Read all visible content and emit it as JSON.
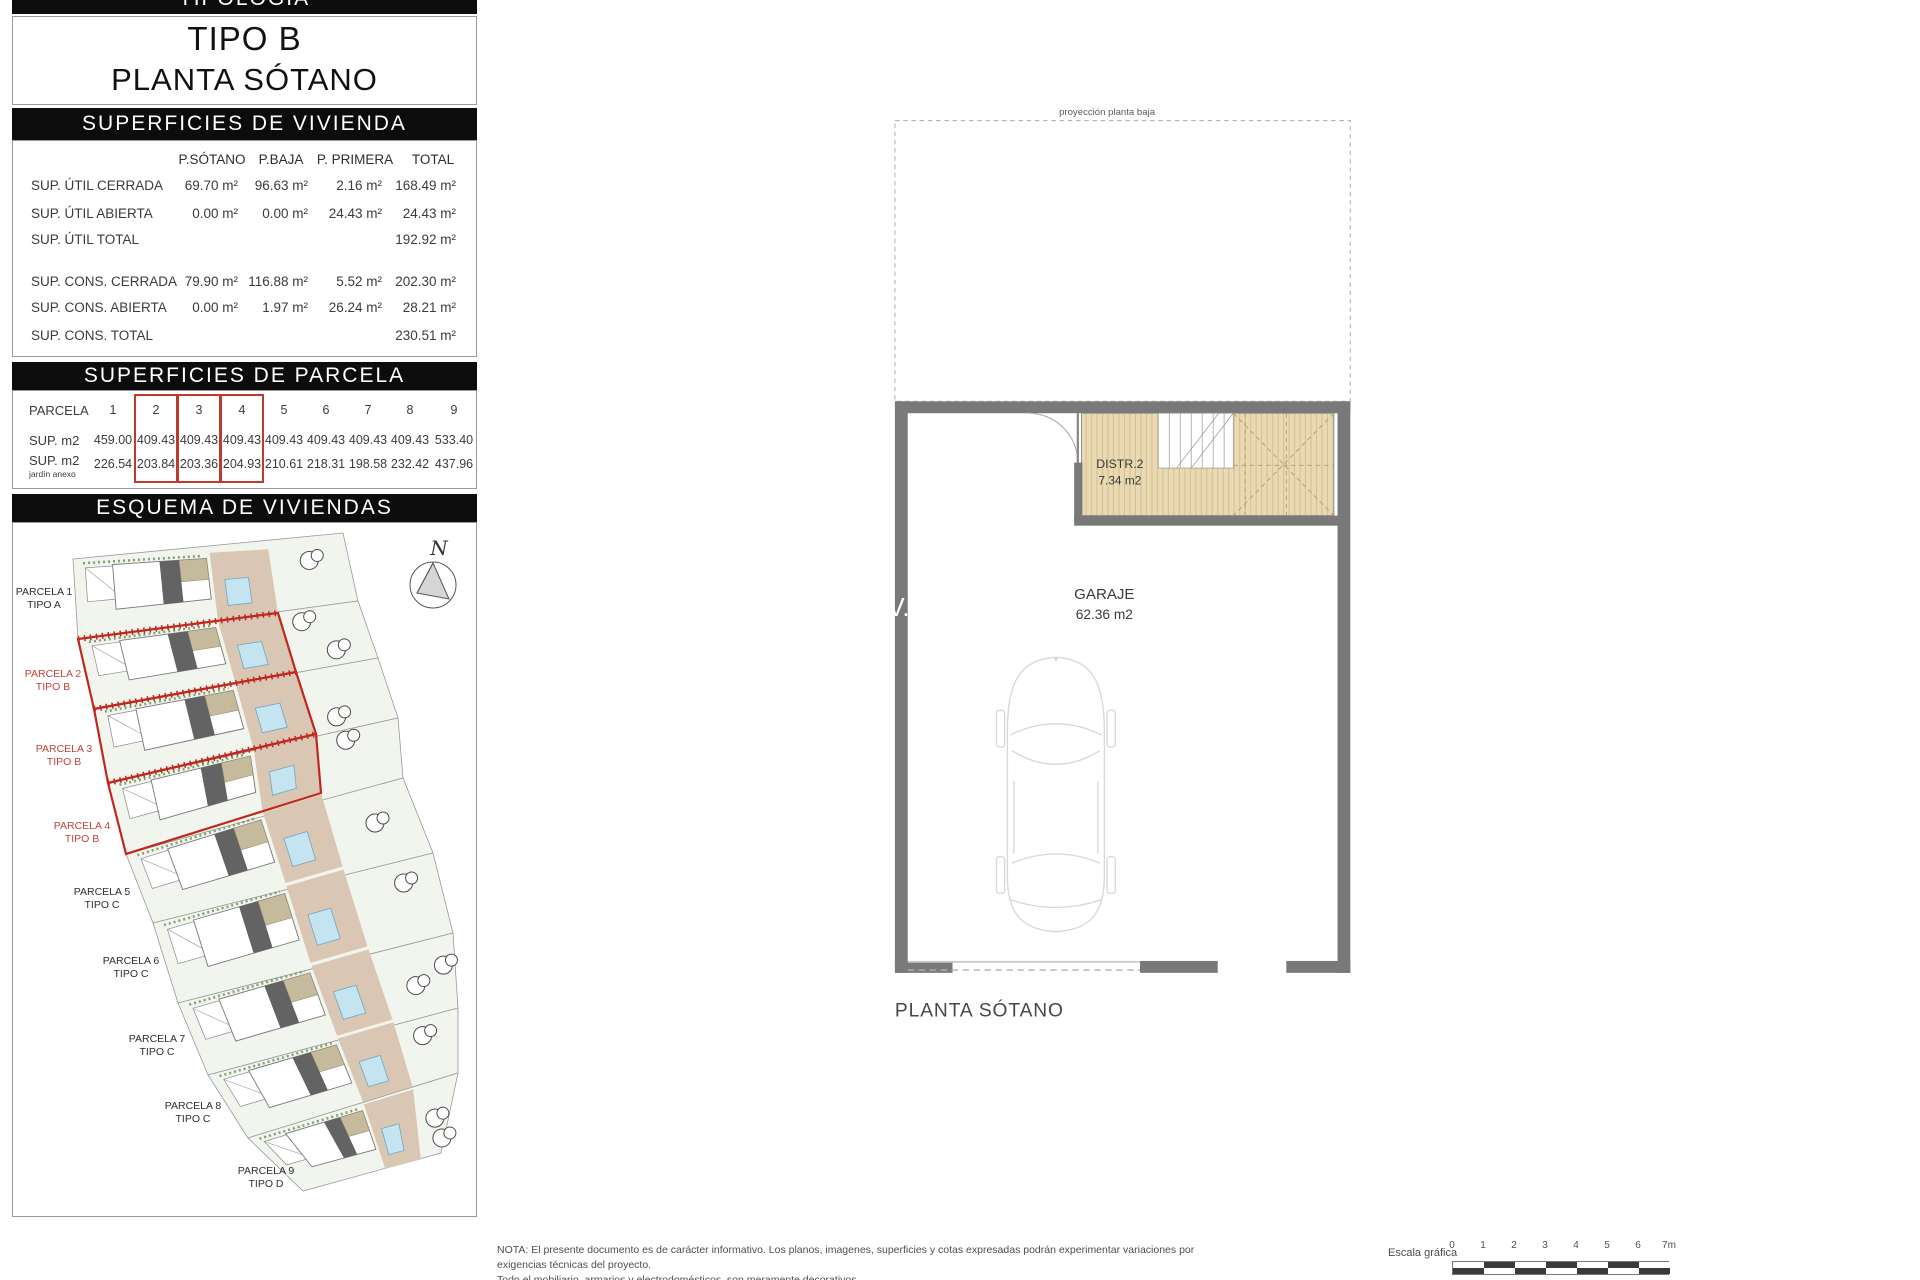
{
  "panel": {
    "banner_tipologia": "TIPOLOGÍA",
    "tipo": "TIPO B",
    "planta": "PLANTA SÓTANO",
    "vivienda": {
      "banner": "SUPERFICIES DE VIVIENDA",
      "columns": [
        "P.SÓTANO",
        "P.BAJA",
        "P. PRIMERA",
        "TOTAL"
      ],
      "rows": [
        {
          "label": "SUP. ÚTIL CERRADA",
          "values": [
            "69.70 m²",
            "96.63 m²",
            "2.16 m²",
            "168.49 m²"
          ]
        },
        {
          "label": "SUP. ÚTIL ABIERTA",
          "values": [
            "0.00 m²",
            "0.00 m²",
            "24.43 m²",
            "24.43 m²"
          ]
        },
        {
          "label": "SUP. ÚTIL TOTAL",
          "values": [
            "",
            "",
            "",
            "192.92 m²"
          ]
        },
        {
          "label": "SUP. CONS. CERRADA",
          "values": [
            "79.90 m²",
            "116.88 m²",
            "5.52 m²",
            "202.30 m²"
          ]
        },
        {
          "label": "SUP. CONS. ABIERTA",
          "values": [
            "0.00 m²",
            "1.97 m²",
            "26.24 m²",
            "28.21 m²"
          ]
        },
        {
          "label": "SUP. CONS. TOTAL",
          "values": [
            "",
            "",
            "",
            "230.51 m²"
          ]
        }
      ]
    },
    "parcela": {
      "banner": "SUPERFICIES DE PARCELA",
      "header_label": "PARCELA",
      "sup_label": "SUP. m2",
      "jardin_label": "SUP. m2",
      "jardin_sublabel": "jardín anexo",
      "numbers": [
        "1",
        "2",
        "3",
        "4",
        "5",
        "6",
        "7",
        "8",
        "9"
      ],
      "sup_values": [
        "459.00",
        "409.43",
        "409.43",
        "409.43",
        "409.43",
        "409.43",
        "409.43",
        "409.43",
        "533.40"
      ],
      "jardin_values": [
        "226.54",
        "203.84",
        "203.36",
        "204.93",
        "210.61",
        "218.31",
        "198.58",
        "232.42",
        "437.96"
      ],
      "highlighted_columns": [
        "2",
        "3",
        "4"
      ]
    },
    "esquema": {
      "banner": "ESQUEMA DE VIVIENDAS",
      "north": "N",
      "parcels": [
        {
          "label": "PARCELA 1",
          "tipo": "TIPO A",
          "red": false
        },
        {
          "label": "PARCELA 2",
          "tipo": "TIPO B",
          "red": true
        },
        {
          "label": "PARCELA 3",
          "tipo": "TIPO B",
          "red": true
        },
        {
          "label": "PARCELA 4",
          "tipo": "TIPO B",
          "red": true
        },
        {
          "label": "PARCELA 5",
          "tipo": "TIPO C",
          "red": false
        },
        {
          "label": "PARCELA 6",
          "tipo": "TIPO C",
          "red": false
        },
        {
          "label": "PARCELA 7",
          "tipo": "TIPO C",
          "red": false
        },
        {
          "label": "PARCELA 8",
          "tipo": "TIPO C",
          "red": false
        },
        {
          "label": "PARCELA 9",
          "tipo": "TIPO D",
          "red": false
        }
      ]
    }
  },
  "plan": {
    "projection_label": "proyección planta baja",
    "distr_name": "DISTR.2",
    "distr_area": "7.34 m2",
    "garaje_name": "GARAJE",
    "garaje_area": "62.36 m2",
    "watermark": "V.",
    "title": "PLANTA SÓTANO"
  },
  "footer": {
    "nota_line1": "NOTA: El presente documento es de carácter informativo. Los planos, imagenes, superficies y cotas expresadas podrán experimentar variaciones por exigencias técnicas del proyecto.",
    "nota_line2": "Todo el mobiliario, armarios y electrodomésticos, son meramente decorativos.",
    "escala_label": "Escala gráfica",
    "ticks": [
      "0",
      "1",
      "2",
      "3",
      "4",
      "5",
      "6",
      "7m"
    ]
  },
  "colors": {
    "banner_bg": "#0c0c0c",
    "wall": "#797979",
    "red": "#c0392b",
    "tan_room": "#e9dab4",
    "pool": "#c3e4f0",
    "parcel_green": "#f1f5ed",
    "driveway": "#d9c7b3"
  }
}
